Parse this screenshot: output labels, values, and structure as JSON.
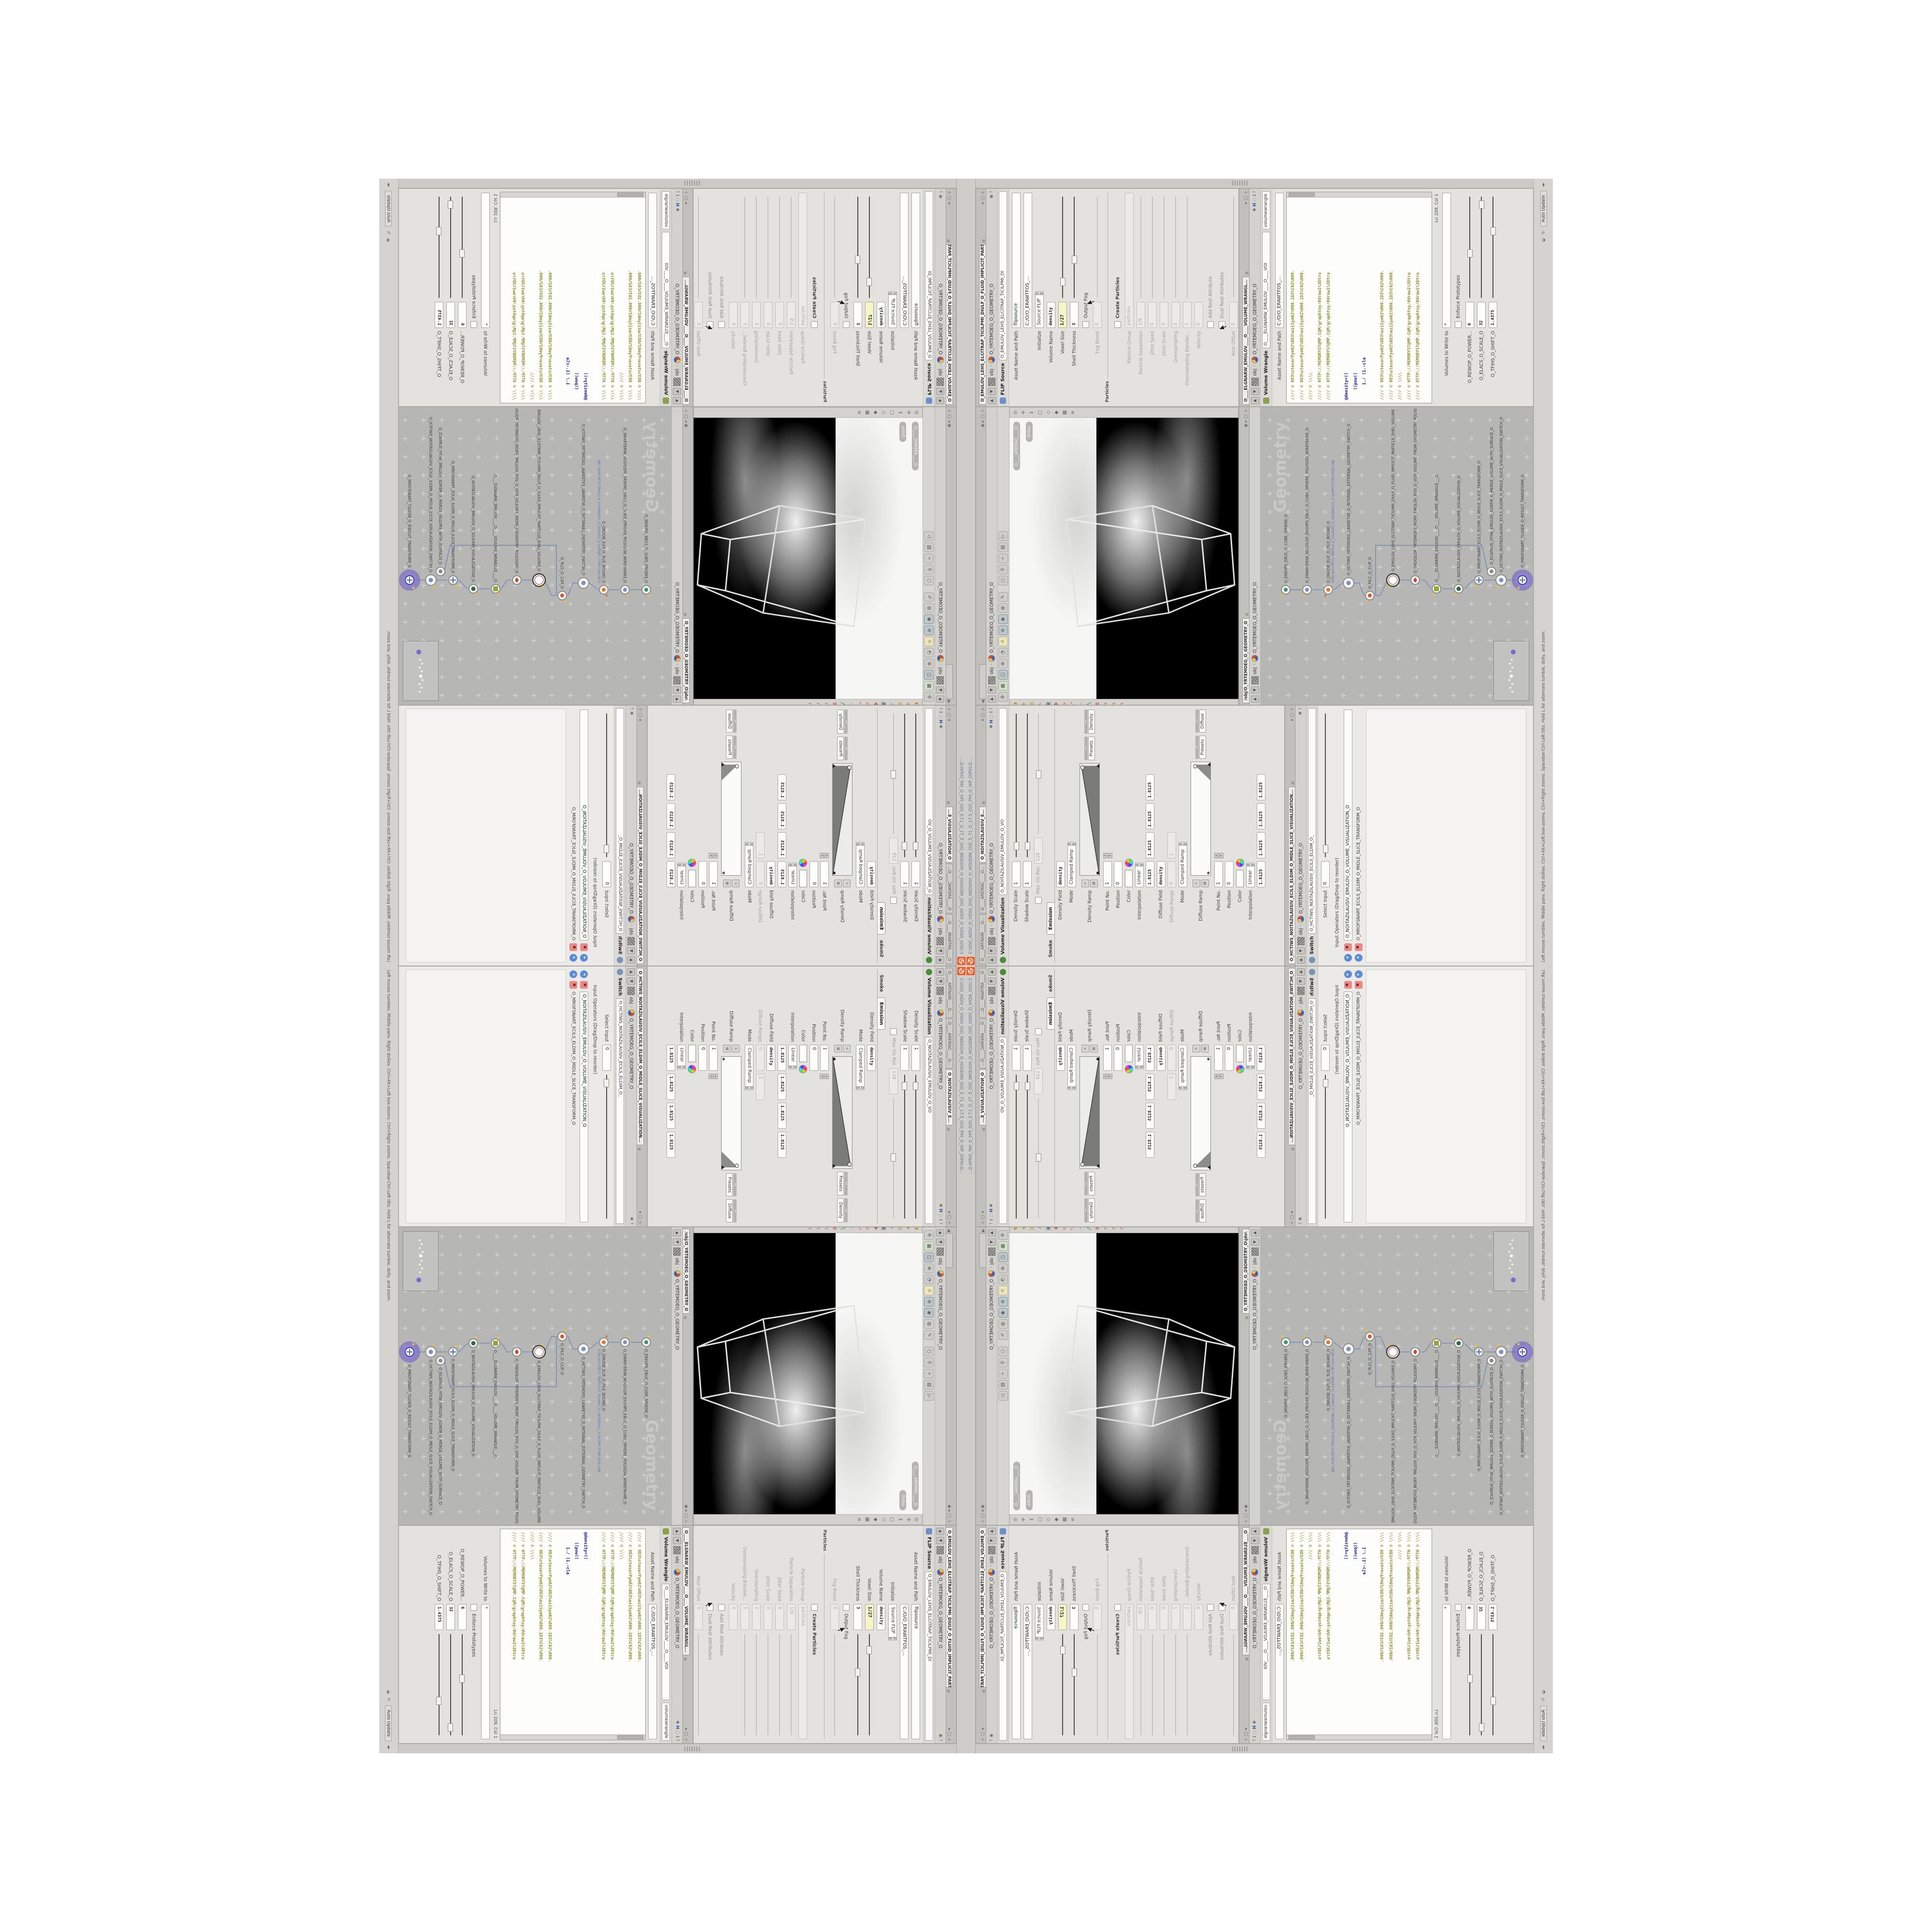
{
  "window": {
    "title": "C:\\O\\O_AIDIV_O_VIDIA_O\\O_INIDUOH_O_HOUDINI_O\\O_5_71_O_17.5_O\\O_PIH_O_HIP_O\\PIH.O...",
    "auto_update": "Auto Update",
    "status_help": "Left mouse tumbles. Middle pans. Right dollies. Ctrl+Alt+Left box-zooms. Ctrl+Right zooms. Spacebar-Ctrl-Left tilts. Hold L for alternate tumble, dolly, and zoom.",
    "accent_orange": "#ef5a24"
  },
  "breadcrumb": {
    "root": "obj",
    "path": "O_YRTEMOEG_O_GEOMETRY_O"
  },
  "flip": {
    "tab": "O_EMULOV_LEHS_ELCITRAP_TICILPMI_DIULF_O_FLUID_IMPLICIT_PARTICLE...",
    "type": "FLIP Source",
    "name_field": "O_EMULOV_LEHS_ELCITRAP_TICILPMI_DI",
    "name2": "flipsource",
    "asset_label": "Asset Name and Path",
    "asset_path": "C:/O/O_ERAWTFOS_...",
    "initialize": {
      "label": "Initialize",
      "value": "Source FLIP"
    },
    "volume_name": {
      "label": "Volume Name",
      "value": "density"
    },
    "voxel_size": {
      "label": "Voxel Size",
      "value": "1/27"
    },
    "shell": {
      "label": "Shell Thickness",
      "value": "3"
    },
    "output_fog": {
      "label": "Output Fog"
    },
    "fog_boost": {
      "label": "Fog Boost",
      "value": "0"
    },
    "group": "Particles",
    "create_particles": {
      "label": "Create Particles"
    },
    "particle_group": {
      "label": "Particle Group",
      "value": "particles"
    },
    "particle_sep": {
      "label": "Particle Separation",
      "value": "1/9"
    },
    "jitter_seed": {
      "label": "Jitter Seed",
      "value": "0"
    },
    "jitter_scale": {
      "label": "Jitter Scale",
      "value": "0"
    },
    "oversampling": {
      "label": "Oversampling",
      "value": "2"
    },
    "oversampling_bw": {
      "label": "Oversampling Bandwi...",
      "value": "1"
    },
    "velocity": {
      "label": "Velocity",
      "value": "0"
    },
    "add_rest": {
      "label": "Add Rest Attribute"
    },
    "dual_rest": {
      "label": "Dual Rest Attributes"
    },
    "rest_offset": {
      "label": "Rest Offset",
      "value": "0"
    }
  },
  "wrangle": {
    "tab": "O____ELGNARW_EMULOV____O____VOLUME_WRANGL...",
    "type": "Volume Wrangle",
    "name_field": "O____ELGNARW_EMULOV____O____VOI",
    "name2": "volumewrangle",
    "asset_label": "Asset Name and Path",
    "asset_path": "C:/O/O_ERAWTFOS_...",
    "code_c1": "//// © 0D3%steserPym62%0D3%eziSym62%000.1D3%C62%000.",
    "code_c2": "//// © 0D3%steserPym62%0D3%eziSym62%000.1D3%C62%000.",
    "code_c3": "//// © \\\\\\\\",
    "code_c4": "//// © HTTP://MEMORYST@MP.C@M/graphtoy/#draw1%3Dtru",
    "code_c5": "//// © HTTP://MEMORYST@MP.C@M/graphtoy/#draw1%3Dtru",
    "code_e1": "@density=((",
    "code_e2": "    ((pow((",
    "code_e3": "      1./ (1.-cla",
    "cursor_pos": "Ln 209, Col 1",
    "volumes": {
      "label": "Volumes to Write to",
      "value": "*"
    },
    "enforce": "Enforce Prototypes",
    "power": {
      "label": "O_REWOP_O_POWER...",
      "value": "6"
    },
    "scale": {
      "label": "O_ELACS_O_SCALE_O",
      "value": "32"
    },
    "shift": {
      "label": "O_TFIHS_O_SHIFT_O",
      "value": "1.4375"
    }
  },
  "scene": {
    "camera_pill": "O____AREMAC____O",
    "view_pill": "Ortho"
  },
  "network": {
    "tab": "/obj/O_YRTEMOEG_O_GEOMETRY_O",
    "watermark": "Geometry",
    "file_note": "O.BD.N03.PET3.TBPDLS.D_5SUKEG_O_GEDRESS1_0-SLOPPT.STEP.3DVL.OBJ",
    "nodes": [
      {
        "name": "O_EREHPS_EBUC_O_CUBE_SPHERE_O"
      },
      {
        "name": "O_EMARFERIW_NOGYLOP_EREHPS_EBUC_O_CUBE_SPHERE_POLYGON_WIREFRAME_O"
      },
      {
        "name": "O_DNUOB_ELIF_O_FILE_BOUND_O"
      },
      {
        "name": "O_HCTIWS_YRTEMOEG_LANRETXE_O_INTERNAL_EXTERNAL_GEOMETRY_SWITCH_O"
      },
      {
        "name": "O_PILC_O_CLIP_O"
      },
      {
        "name": "O_EMULOV_LEHS_ELCITRAP_TICILPMI_DIULF_O_FLUID_IMPLICIT_PARTICLE_SHEL_VOLUME"
      },
      {
        "name": "O_SNOGILOP_YRTEMOEG_MORF_EMULOV_BDV_O_VDB_VOLUME_FROM_GEOMETRY_POLYG"
      },
      {
        "name": "O____ELGNARW_EMULOV____O____VOLUME_WRANGLE___O"
      },
      {
        "name": "O_NOITAZILAUSIV_EMULOV_O_VOLUME_VISUALIZATION_O"
      },
      {
        "name": "O_MROFSNART_ECILS_ELDIM_O_MIDLE_SLICE_TRANSFORM_O"
      },
      {
        "name": "O_HCTIWS_NOITAZILAUSIV_ECILS_ELDIM_O_MIDLE_SLICE_VISUALIZATION_SWITCH_O"
      },
      {
        "name": "O_ECAFRUS_HTIW_EMULOV_EGREM_O_MERGE_VOLUME_WITH_SURFACE_O"
      },
      {
        "name": "O_MROFSNART_TLUSER_O_RESULT_TRANSFORM_O"
      }
    ]
  },
  "viz": {
    "tab1": "O____ARTNAM____O...",
    "tab2": "O____AREMAC____O...",
    "tab3": "O_NOITAZILAUSIV_E...",
    "type": "Volume Visualization",
    "name_field": "O_NOITAZILAUSIV_EMULOV_O_VO",
    "density_scale": {
      "label": "Density Scale",
      "value": "1"
    },
    "shadow_scale": {
      "label": "Shadow Scale",
      "value": "1"
    },
    "max_vis": {
      "label": "Max Vis Res",
      "value": "128"
    },
    "tab_smoke": "Smoke",
    "tab_emission": "Emission",
    "density_field": {
      "label": "Density Field",
      "value": "density"
    },
    "mode1": {
      "label": "Mode",
      "value": "Clamped Ramp"
    },
    "density_ramp": {
      "label": "Density Ramp",
      "presets": "Presets",
      "preset_value": "Density"
    },
    "point_no": {
      "label": "Point No.",
      "value": "1"
    },
    "position": {
      "label": "Position",
      "value": "0"
    },
    "color": {
      "label": "Color"
    },
    "interp": {
      "label": "Interpolation",
      "value": "Linear"
    },
    "quad": [
      "1.8125",
      "1.8125",
      "1.8125",
      "1.8125"
    ],
    "diffuse_field": {
      "label": "Diffuse Field",
      "value": "density"
    },
    "diffuse_range": {
      "label": "Diffuse Range",
      "v1": "0",
      "v2": "1"
    },
    "mode2": {
      "label": "Mode",
      "value": "Clamped Ramp"
    },
    "diffuse_ramp": {
      "label": "Diffuse Ramp",
      "presets": "Presets",
      "preset_value": "Diffuse"
    }
  },
  "switch": {
    "tab": "O_HCTIWS_NOITAZILAUSIV_ECILS_ELDIM_O_MIDLE_SLICE_VISUALIZATION...",
    "type": "Switch",
    "name_field": "O_HCTIWS_NOITAZILAUSIV_ECILS_ELDIM_O_",
    "select_input": {
      "label": "Select Input",
      "value": "0"
    },
    "list_label": "Input Operators (Drag/Drop to reorder)",
    "input1": "O_NOITAZILAUSIV_EMULOV_O_VOLUME_VISUALIZATION_O",
    "input2": "O_MROFSNART_ECILS_ELDIM_O_MIDLE_SLICE_TRANSFORM_O"
  }
}
